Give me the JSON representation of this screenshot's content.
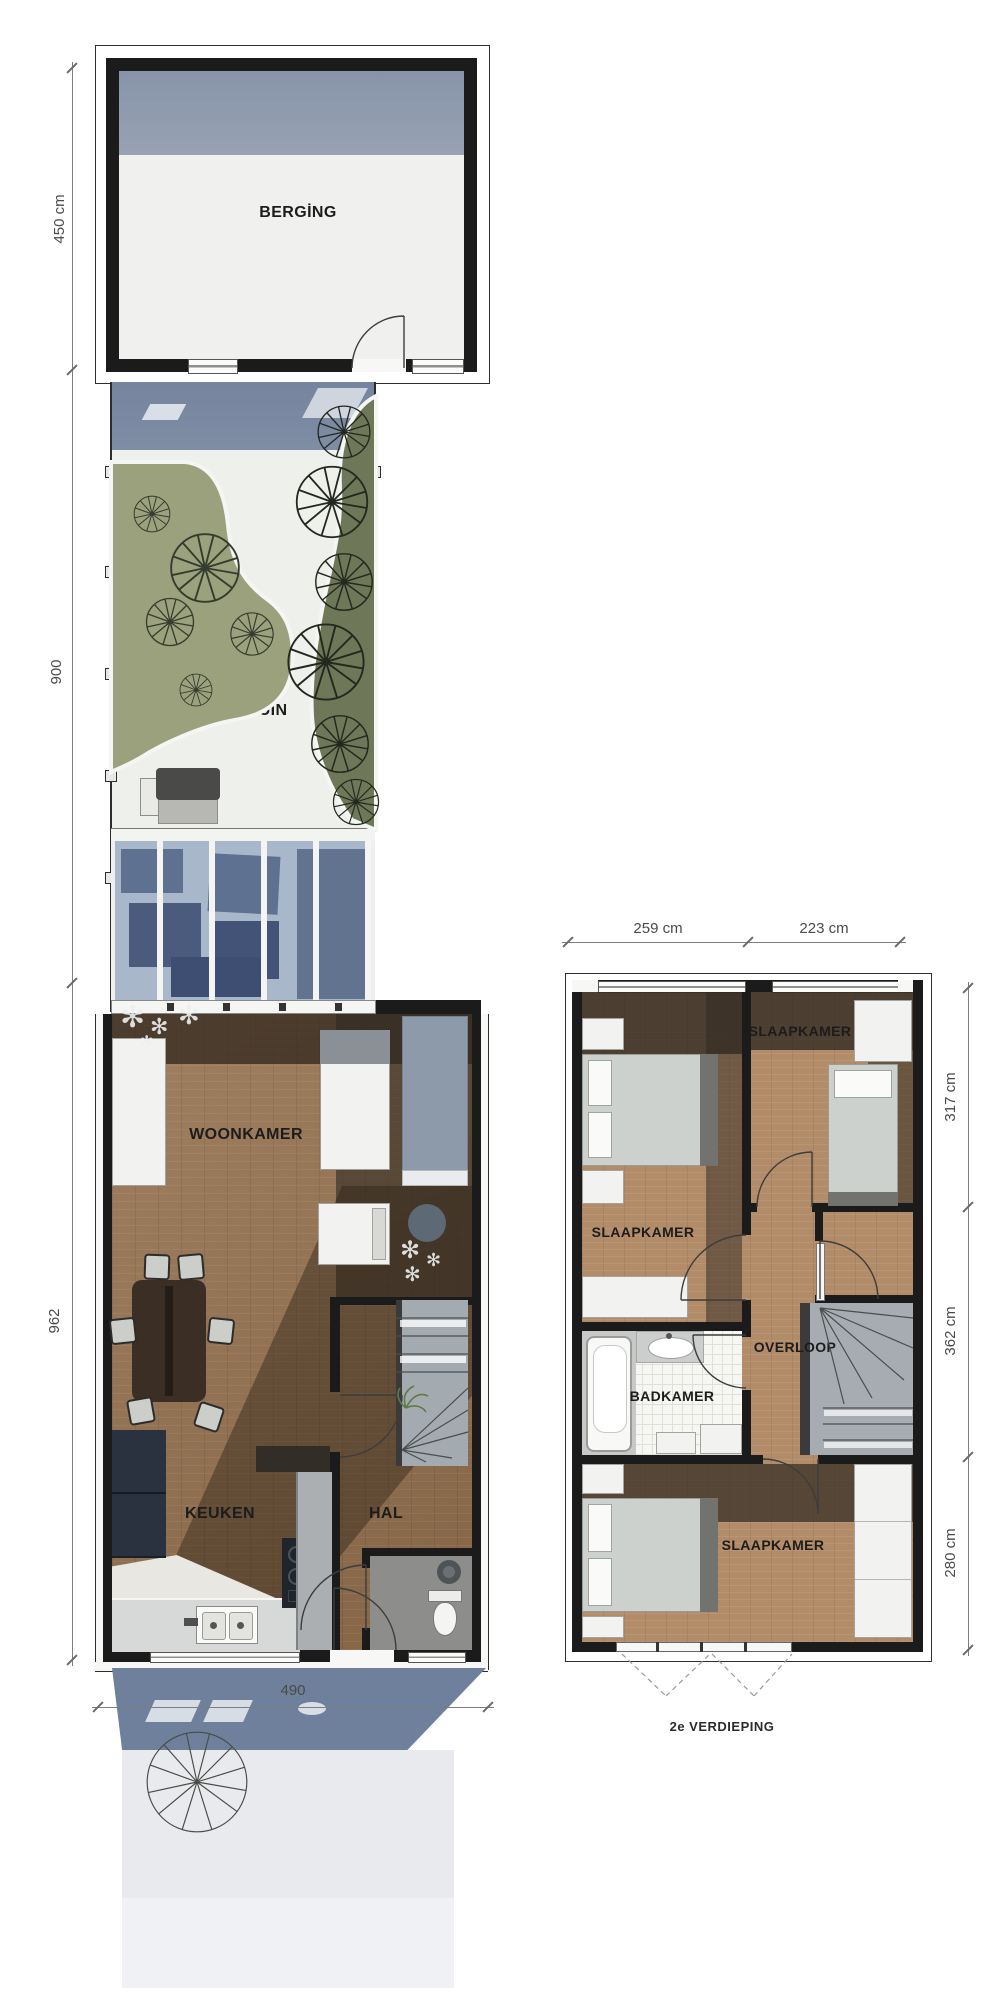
{
  "ground_floor": {
    "rooms": {
      "berging": "BERGİNG",
      "tuin": "TUİN",
      "woonkamer": "WOONKAMER",
      "keuken": "KEUKEN",
      "hal": "HAL"
    },
    "dims": {
      "berging_depth": "450 cm",
      "tuin_depth": "900",
      "living_depth": "962",
      "width": "490"
    }
  },
  "second_floor": {
    "caption": "2e VERDIEPING",
    "rooms": {
      "slaapkamer_left": "SLAAPKAMER",
      "slaapkamer_right": "SLAAPKAMER",
      "slaapkamer_bottom": "SLAAPKAMER",
      "overloop": "OVERLOOP",
      "badkamer": "BADKAMER"
    },
    "dims": {
      "width_left": "259 cm",
      "width_right": "223 cm",
      "top_depth": "317 cm",
      "middle_depth": "362 cm",
      "bottom_depth": "280 cm"
    }
  },
  "colors": {
    "shadow_blue": "#76849e",
    "garden_green": "#9ba17c",
    "garden_green_dark": "#6e7757",
    "glass": "#a9b7ca",
    "wood_dark": "#96724f",
    "wood_light": "#b28c69",
    "wall": "#1b1b1b"
  }
}
